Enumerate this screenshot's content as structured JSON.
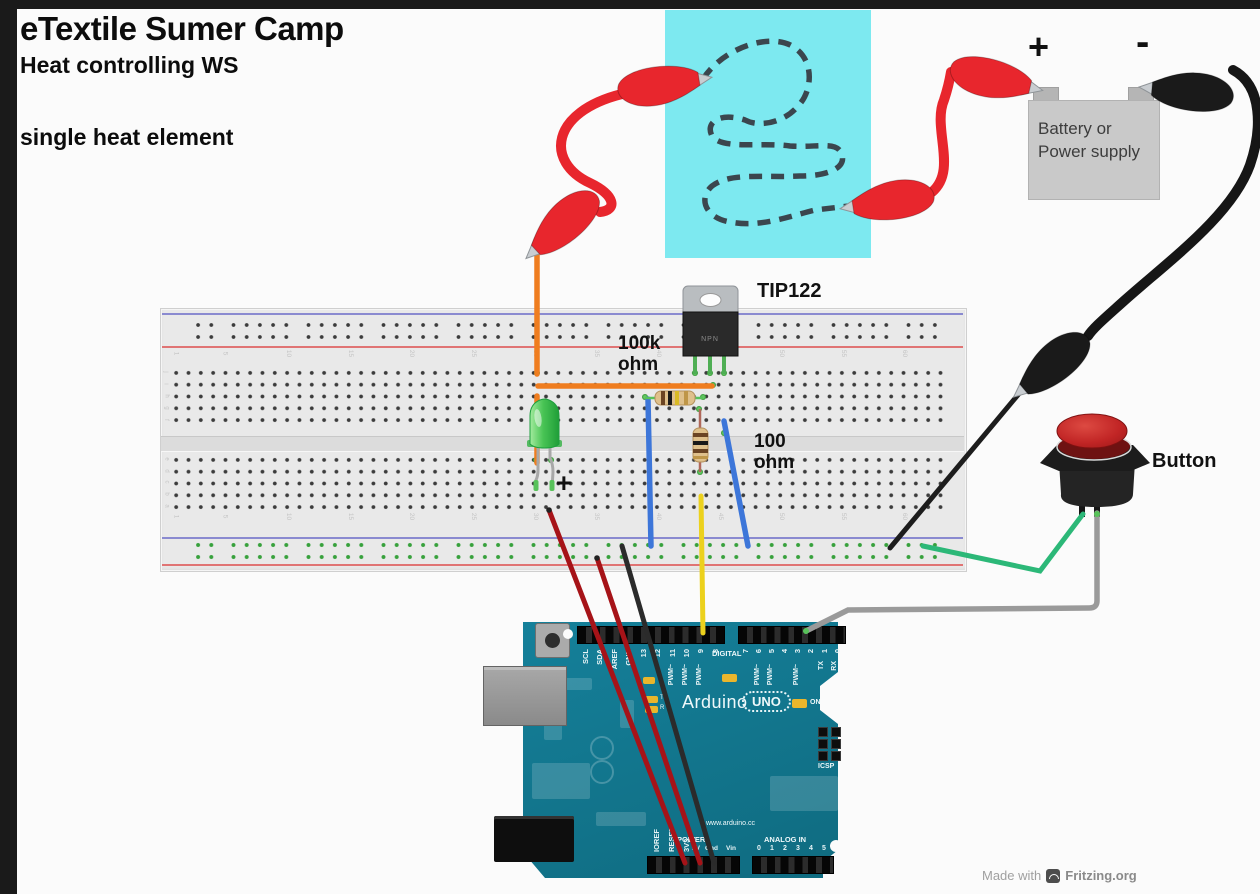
{
  "titles": {
    "main": "eTextile Sumer Camp",
    "subtitle": "Heat controlling WS",
    "variant": "single heat element"
  },
  "battery": {
    "plus": "+",
    "minus": "-",
    "line1": "Battery or",
    "line2": "Power supply"
  },
  "labels": {
    "transistor": "TIP122",
    "transistor_marking": "NPN",
    "resistor1_value": "100k",
    "resistor1_unit": "ohm",
    "resistor2_value": "100",
    "resistor2_unit": "ohm",
    "led_polarity": "+",
    "button": "Button"
  },
  "footer": {
    "made_with": "Made with",
    "brand": "Fritzing.org"
  },
  "arduino": {
    "logo": "Arduino",
    "model": "UNO",
    "on": "ON",
    "digital": "DIGITAL",
    "icsp": "ICSP",
    "url": "www.arduino.cc",
    "power": "POWER",
    "analog": "ANALOG IN",
    "tx_led": "T",
    "rx_led": "R",
    "top_pins_left": [
      {
        "t": "SCL",
        "x": 581
      },
      {
        "t": "SDA",
        "x": 595
      },
      {
        "t": "AREF",
        "x": 610
      },
      {
        "t": "GND",
        "x": 624
      },
      {
        "t": "13",
        "x": 639
      },
      {
        "t": "12",
        "x": 653
      },
      {
        "t": "11",
        "x": 668
      },
      {
        "t": "10",
        "x": 682
      },
      {
        "t": "9",
        "x": 696
      },
      {
        "t": "8",
        "x": 711
      }
    ],
    "top_pins_right": [
      {
        "t": "7",
        "x": 741
      },
      {
        "t": "6",
        "x": 754
      },
      {
        "t": "5",
        "x": 767
      },
      {
        "t": "4",
        "x": 780
      },
      {
        "t": "3",
        "x": 793
      },
      {
        "t": "2",
        "x": 806
      },
      {
        "t": "1",
        "x": 820
      },
      {
        "t": "0",
        "x": 833
      }
    ],
    "pwm_labels": [
      {
        "t": "PWM~",
        "x": 668
      },
      {
        "t": "PWM~",
        "x": 682
      },
      {
        "t": "PWM~",
        "x": 696
      },
      {
        "t": "PWM~",
        "x": 754
      },
      {
        "t": "PWM~",
        "x": 767
      },
      {
        "t": "PWM~",
        "x": 793
      }
    ],
    "serial_labels": [
      {
        "t": "TX",
        "x": 818
      },
      {
        "t": "RX",
        "x": 831
      }
    ],
    "power_pins_vertical": [
      {
        "t": "IOREF",
        "x": 652
      },
      {
        "t": "RESET",
        "x": 667
      },
      {
        "t": "3V3",
        "x": 682
      }
    ],
    "power_pins_small": [
      {
        "t": "5V",
        "x": 692
      },
      {
        "t": "Gnd",
        "x": 705
      },
      {
        "t": "Vin",
        "x": 726
      }
    ],
    "analog_digits": [
      {
        "t": "0",
        "x": 757
      },
      {
        "t": "1",
        "x": 770
      },
      {
        "t": "2",
        "x": 783
      },
      {
        "t": "3",
        "x": 796
      },
      {
        "t": "4",
        "x": 809
      },
      {
        "t": "5",
        "x": 822
      }
    ]
  },
  "breadboard": {
    "column_numbers": [
      {
        "t": "1",
        "x": 174
      },
      {
        "t": "5",
        "x": 223
      },
      {
        "t": "10",
        "x": 285
      },
      {
        "t": "15",
        "x": 347
      },
      {
        "t": "20",
        "x": 408
      },
      {
        "t": "25",
        "x": 470
      },
      {
        "t": "30",
        "x": 532
      },
      {
        "t": "35",
        "x": 593
      },
      {
        "t": "40",
        "x": 655
      },
      {
        "t": "45",
        "x": 717
      },
      {
        "t": "50",
        "x": 778
      },
      {
        "t": "55",
        "x": 840
      },
      {
        "t": "60",
        "x": 901
      }
    ],
    "row_letters_top": [
      {
        "t": "j",
        "y": 369
      },
      {
        "t": "i",
        "y": 381
      },
      {
        "t": "h",
        "y": 393
      },
      {
        "t": "g",
        "y": 405
      },
      {
        "t": "f",
        "y": 417
      }
    ],
    "row_letters_bottom": [
      {
        "t": "e",
        "y": 456
      },
      {
        "t": "d",
        "y": 468
      },
      {
        "t": "c",
        "y": 479
      },
      {
        "t": "b",
        "y": 491
      },
      {
        "t": "a",
        "y": 503
      }
    ],
    "green_holes": [
      {
        "x": 537,
        "y": 373
      },
      {
        "x": 695,
        "y": 373
      },
      {
        "x": 710,
        "y": 373
      },
      {
        "x": 724,
        "y": 373
      },
      {
        "x": 713,
        "y": 385
      },
      {
        "x": 645,
        "y": 397
      },
      {
        "x": 703,
        "y": 397
      },
      {
        "x": 699,
        "y": 409
      },
      {
        "x": 724,
        "y": 433
      },
      {
        "x": 700,
        "y": 472
      },
      {
        "x": 536,
        "y": 460
      },
      {
        "x": 551,
        "y": 460
      }
    ]
  },
  "colors": {
    "fabric_cyan": "#7de9f0",
    "board_teal": "#12758a",
    "clip_red": "#e8262d",
    "wire_orange": "#ef7d1f",
    "wire_blue": "#3d76d9",
    "wire_yellow": "#ecd11d",
    "wire_green": "#2cb878",
    "wire_gray": "#9a9a9a",
    "wire_dark_red": "#a61318",
    "button_red": "#c12525",
    "breadboard_gray": "#e9e9e9",
    "battery_gray": "#c9c9c9"
  }
}
